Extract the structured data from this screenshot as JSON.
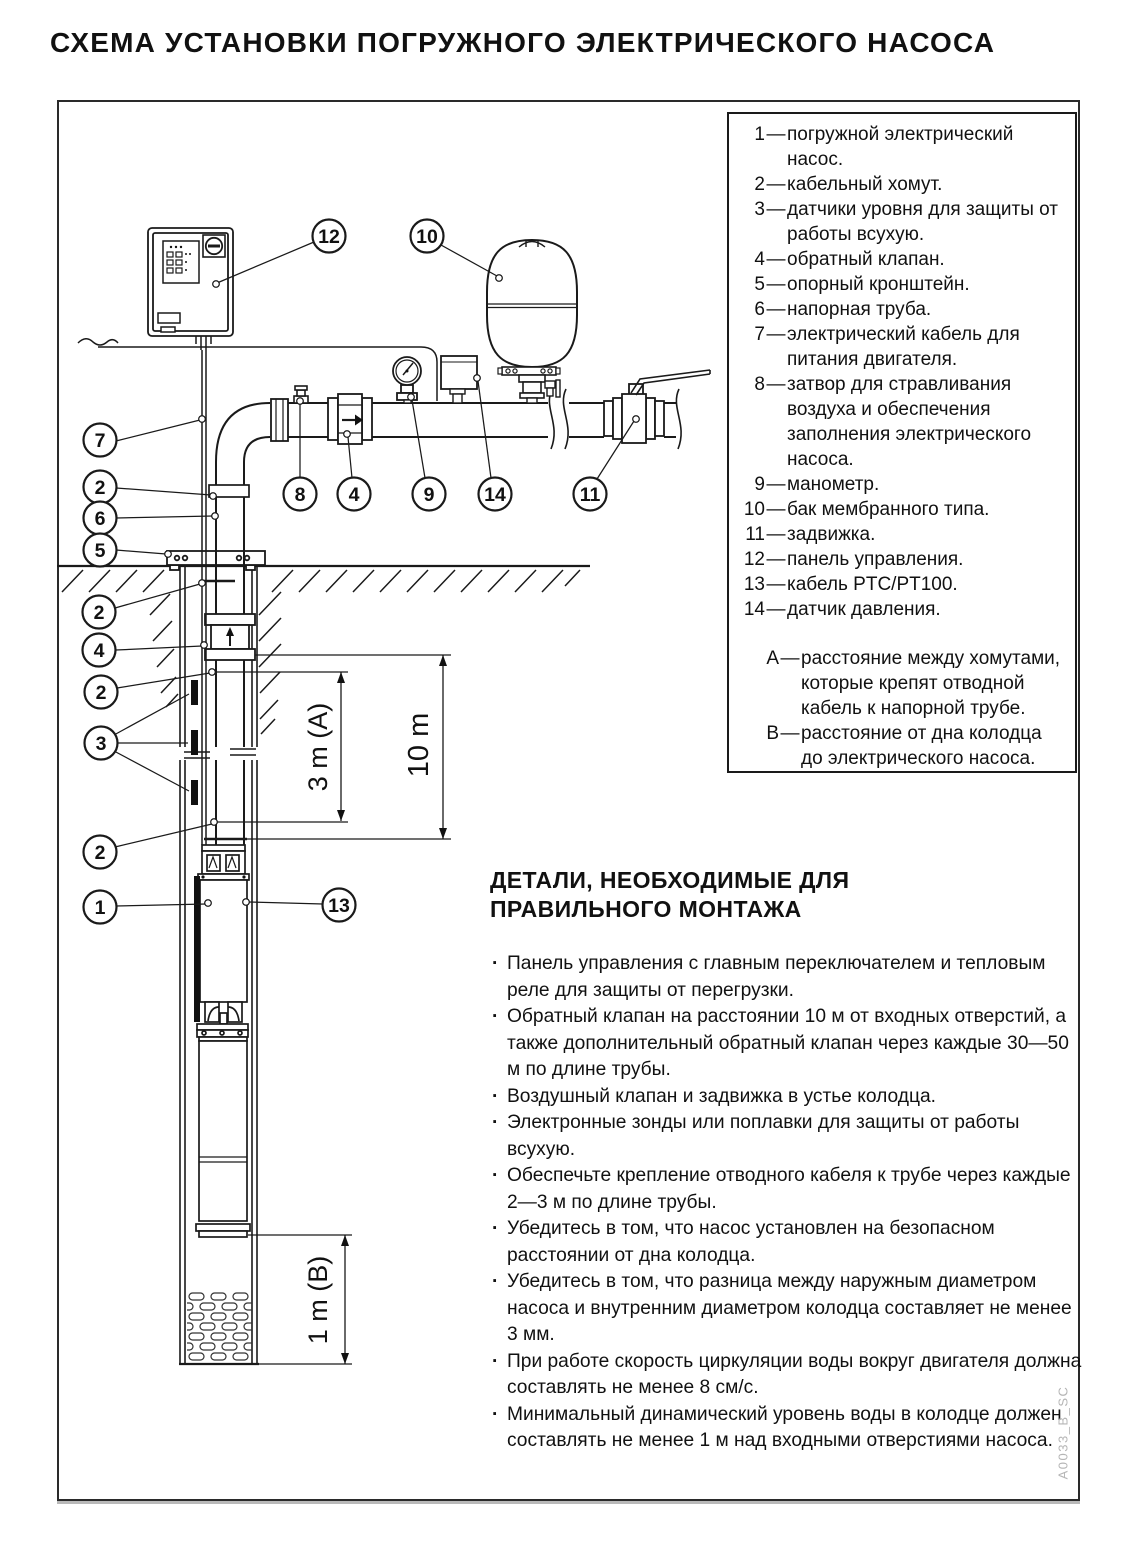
{
  "title": "СХЕМА УСТАНОВКИ ПОГРУЖНОГО ЭЛЕКТРИЧЕСКОГО НАСОСА",
  "legend": {
    "sep": "—",
    "items": [
      {
        "num": "1",
        "text": "погружной электрический насос."
      },
      {
        "num": "2",
        "text": "кабельный хомут."
      },
      {
        "num": "3",
        "text": "датчики уровня для защиты от работы всухую."
      },
      {
        "num": "4",
        "text": "обратный клапан."
      },
      {
        "num": "5",
        "text": "опорный кронштейн."
      },
      {
        "num": "6",
        "text": "напорная труба."
      },
      {
        "num": "7",
        "text": "электрический кабель для питания двигателя."
      },
      {
        "num": "8",
        "text": "затвор для стравливания воздуха и обеспечения заполнения электрического насоса."
      },
      {
        "num": "9",
        "text": "манометр."
      },
      {
        "num": "10",
        "text": "бак мембранного типа."
      },
      {
        "num": "11",
        "text": "задвижка."
      },
      {
        "num": "12",
        "text": "панель управления."
      },
      {
        "num": "13",
        "text": "кабель PTC/PT100."
      },
      {
        "num": "14",
        "text": "датчик давления."
      }
    ],
    "notes": [
      {
        "num": "A",
        "text": "расстояние между хомутами, которые крепят отводной кабель к напорной трубе."
      },
      {
        "num": "B",
        "text": "расстояние от дна колодца до электрического насоса."
      }
    ]
  },
  "parts": {
    "heading_line1": "ДЕТАЛИ, НЕОБХОДИМЫЕ ДЛЯ",
    "heading_line2": "ПРАВИЛЬНОГО МОНТАЖА",
    "items": [
      "Панель управления с главным переключателем и тепловым реле для защиты от перегрузки.",
      "Обратный клапан на расстоянии 10 м от входных отверстий, а также дополнительный обратный клапан через каждые 30—50 м по длине трубы.",
      "Воздушный клапан и задвижка в устье колодца.",
      "Электронные зонды или поплавки для защиты от работы всухую.",
      "Обеспечьте крепление отводного кабеля к трубе через каждые 2—3 м по длине трубы.",
      "Убедитесь в том, что насос установлен на безопасном расстоянии от дна колодца.",
      "Убедитесь в том, что разница между наружным диаметром насоса и внутренним диаметром колодца составляет не менее 3 мм.",
      "При работе скорость циркуляции воды вокруг двигателя должна составлять не менее 8 см/с.",
      "Минимальный динамический уровень воды в колодце должен составлять не менее 1 м над входными отверстиями насоса."
    ]
  },
  "diagram": {
    "callouts": [
      "12",
      "10",
      "7",
      "2",
      "6",
      "5",
      "2",
      "4",
      "2",
      "3",
      "2",
      "1",
      "13",
      "8",
      "4",
      "9",
      "14",
      "11"
    ],
    "dimensions": {
      "a": "3 m (A)",
      "b": "10 m",
      "c": "1 m (B)"
    }
  },
  "footer_code": "A0033_B_SC",
  "colors": {
    "line": "#1a1a1a",
    "text": "#111111",
    "footer": "#b5b5b5"
  }
}
